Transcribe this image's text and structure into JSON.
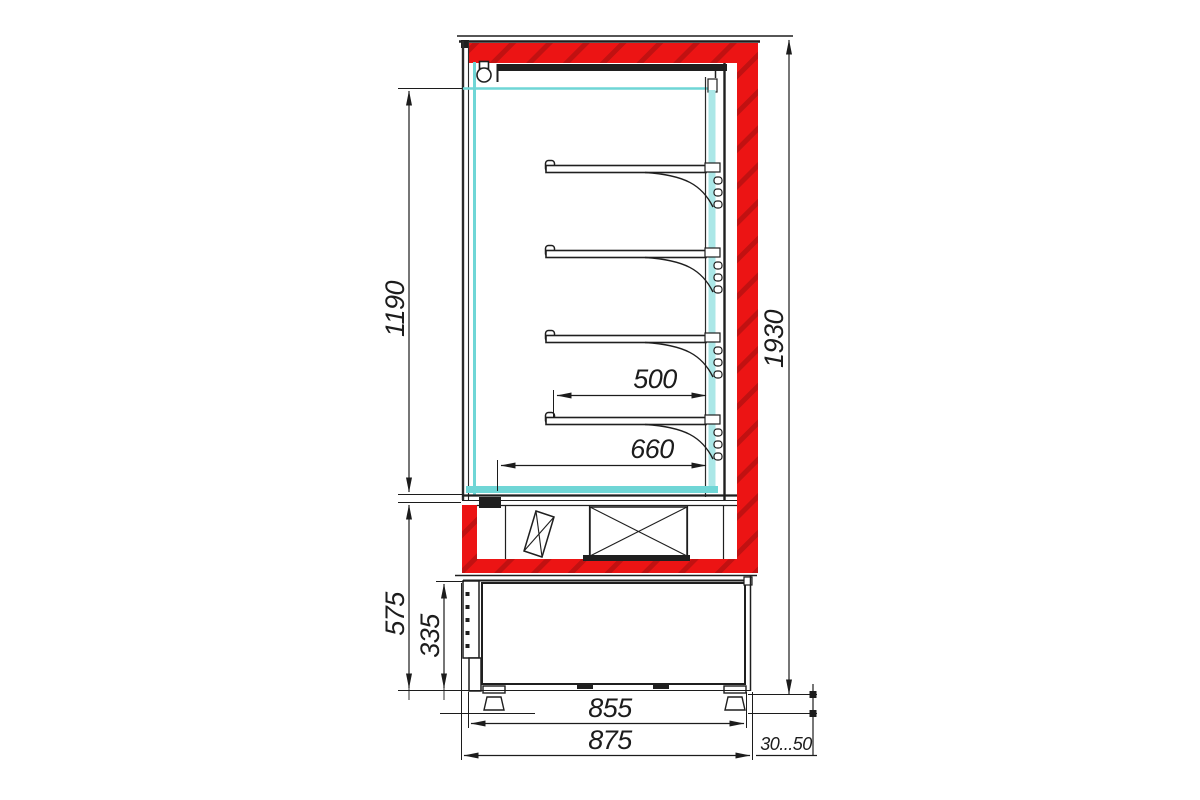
{
  "drawing": {
    "kind": "refrigerated-display-case-side-section",
    "shelf_count": 4,
    "colors": {
      "insulation_red": "#ec1414",
      "insulation_red_hatch": "#b50f0f",
      "glass_cyan": "#6fd6d6",
      "glass_cyan_pale": "#abe7e7",
      "line_black": "#1f1f1f"
    },
    "dimensions": {
      "interior_height": "1190",
      "overall_height": "1930",
      "shelf_depth": "500",
      "interior_depth": "660",
      "base_height": "575",
      "machine_compartment_height": "335",
      "base_width": "855",
      "overall_depth": "875",
      "wall_clearance": "30...50"
    }
  }
}
